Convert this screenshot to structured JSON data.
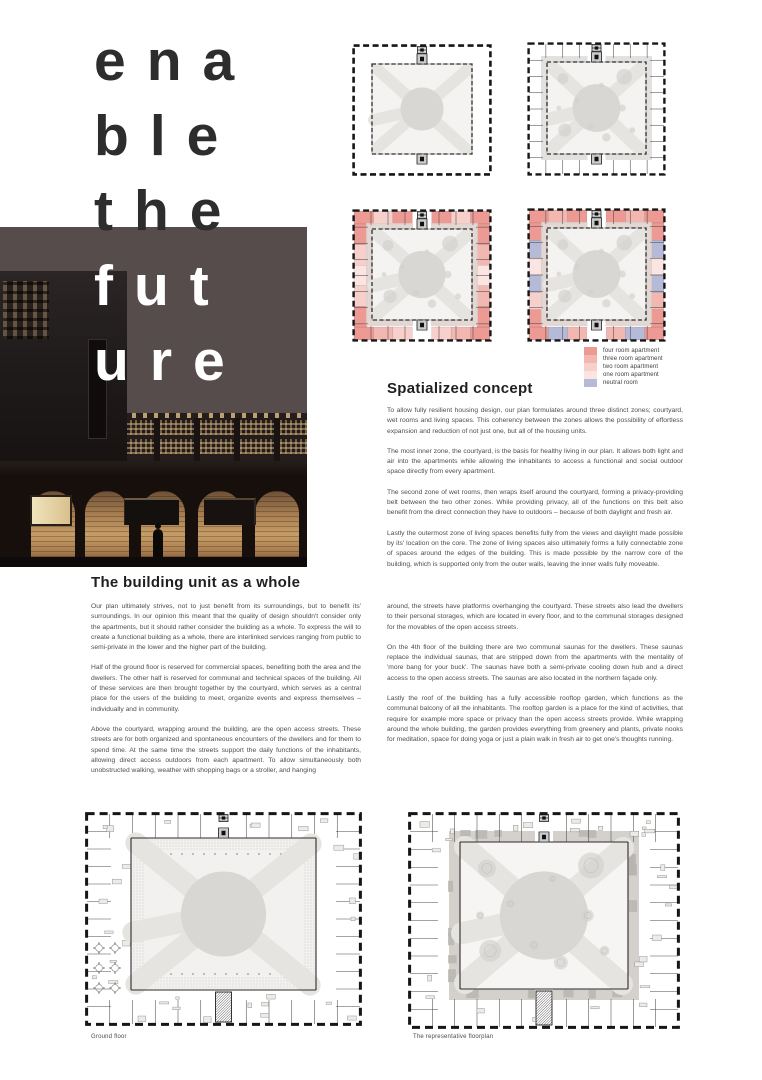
{
  "title": {
    "lines": [
      "ena",
      "ble",
      "the",
      "fut",
      "ure"
    ]
  },
  "hero": {
    "description": "dusk photo render of brick housing block with perforated parapet and arched colonnade"
  },
  "legend": {
    "items": [
      {
        "label": "four room apartment",
        "color": "#ec9a93"
      },
      {
        "label": "three room apartment",
        "color": "#f2b7b1"
      },
      {
        "label": "two room apartment",
        "color": "#f7cfcb"
      },
      {
        "label": "one room apartment",
        "color": "#fbe4e2"
      },
      {
        "label": "neutral room",
        "color": "#b4bad8"
      }
    ]
  },
  "spatialized": {
    "heading": "Spatialized concept",
    "paragraphs": [
      "To allow fully resilient housing design, our plan formulates around three distinct zones; courtyard, wet rooms and living spaces. This coherency between the zones allows the possibility of effortless expansion and reduction of not just one, but all of the housing units.",
      "The most inner zone, the courtyard, is the basis for healthy living in our plan. It allows both light and air into the apartments while allowing the inhabitants to access a functional and social outdoor space directly from every apartment.",
      "The second zone of wet rooms, then wraps itself around the courtyard, forming a privacy-providing belt between the two other zones. While providing privacy, all of the functions on this belt also benefit from the direct connection they have to outdoors – because of both daylight and fresh air.",
      "Lastly the outermost zone of living spaces benefits fully from the views and daylight made possible by its' location on the core. The zone of living spaces also ultimately forms a fully connectable zone of spaces around the edges of the building. This is made possible by the narrow core of the building, which is supported only from the outer walls, leaving the inner walls fully moveable."
    ]
  },
  "building_unit": {
    "heading": "The building unit as a whole",
    "col_left": [
      "Our plan ultimately strives, not to just benefit from its surroundings, but to benefit its' surroundings. In our opinion this meant that the quality of design shouldn't consider only the apartments, but it should rather consider the building as a whole. To express the will to create a functional building as a whole, there are interlinked services ranging from public to semi-private in the lower and the higher part of the building.",
      "Half of the ground floor is reserved for commercial spaces, benefiting both the area and the dwellers. The other half is reserved for communal and technical spaces of the building. All of these services are then brought together by the courtyard, which serves as a central place for the users of the building to meet, organize events and express themselves – individually and in community.",
      "Above the courtyard, wrapping around the building, are the open access streets. These streets are for both organized and spontaneous encounters of the dwellers and for them to spend time. At the same time the streets support the daily functions of the inhabitants, allowing direct access outdoors from each apartment. To allow simultaneously both unobstructed walking, weather with shopping bags or a stroller, and hanging"
    ],
    "col_right": [
      "around, the streets have platforms overhanging the courtyard. These streets also lead the dwellers to their personal storages, which are located in every floor, and to the communal storages designed for the movables of the open access streets.",
      "On the 4th floor of the building there are two communal saunas for the dwellers. These saunas replace the individual saunas, that are stripped down from the apartments with the mentality of 'more bang for your buck'. The saunas have both a semi-private cooling down hub and a direct access to the open access streets. The saunas are also located in the northern façade only.",
      "Lastly the roof of the building has a fully accessible rooftop garden, which functions as the communal balcony of all the inhabitants. The rooftop garden is a place for the kind of activities, that require for example more space or privacy than the open access streets provide. While wrapping around the whole building, the garden provides everything from greenery and plants, private nooks for meditation, space for doing yoga or just a plain walk in fresh air to get one's thoughts running."
    ]
  },
  "floorplans": {
    "ground_caption": "Ground floor",
    "representative_caption": "The representative floorplan"
  }
}
